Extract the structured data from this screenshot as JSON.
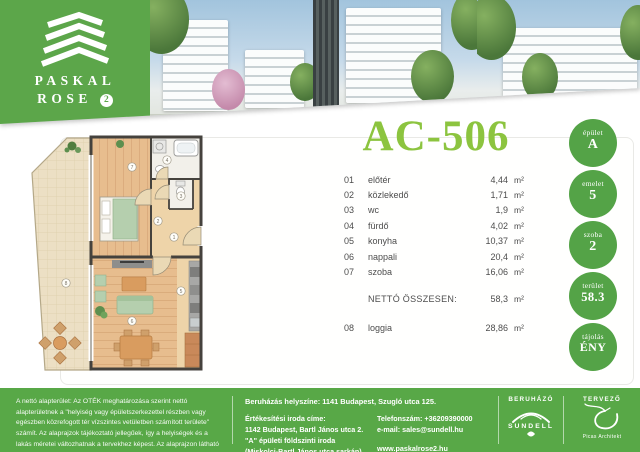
{
  "colors": {
    "brand_green": "#5ca64a",
    "badge_green": "#54a347",
    "footer_green": "#58a847",
    "title_green": "#8cc43f"
  },
  "logo": {
    "line1": "PASKAL",
    "line2": "ROSE",
    "badge": "2"
  },
  "unit": {
    "code": "AC-506"
  },
  "rooms": [
    {
      "num": "01",
      "name": "előtér",
      "area": "4,44",
      "unit": "m²"
    },
    {
      "num": "02",
      "name": "közlekedő",
      "area": "1,71",
      "unit": "m²"
    },
    {
      "num": "03",
      "name": "wc",
      "area": "1,9",
      "unit": "m²"
    },
    {
      "num": "04",
      "name": "fürdő",
      "area": "4,02",
      "unit": "m²"
    },
    {
      "num": "05",
      "name": "konyha",
      "area": "10,37",
      "unit": "m²"
    },
    {
      "num": "06",
      "name": "nappali",
      "area": "20,4",
      "unit": "m²"
    },
    {
      "num": "07",
      "name": "szoba",
      "area": "16,06",
      "unit": "m²"
    }
  ],
  "total": {
    "label": "NETTÓ ÖSSZESEN:",
    "value": "58,3",
    "unit": "m²"
  },
  "loggia_row": {
    "num": "08",
    "name": "loggia",
    "area": "28,86",
    "unit": "m²"
  },
  "badges": [
    {
      "label": "épület",
      "value": "A"
    },
    {
      "label": "emelet",
      "value": "5"
    },
    {
      "label": "szoba",
      "value": "2"
    },
    {
      "label": "terület",
      "value": "58.3"
    },
    {
      "label": "tájolás",
      "value": "ÉNY"
    }
  ],
  "plan": {
    "numbers": [
      "1",
      "2",
      "3",
      "4",
      "5",
      "6",
      "7",
      "8"
    ]
  },
  "footer": {
    "disclaimer": "A nettó alapterület: Az OTÉK meghatározása szerint nettó alapterületnek a \"helyiség vagy épületszerkezettel részben vagy egészben közrefogott tér vízszintes vetületben számított területe\" számít. Az alaprajzok tájékoztató jellegűek, így a helyiségek és a lakás méretei változhatnak a tervekhez képest. Az alaprajzon látható bútorok illusztrációk, pontos felszereltség a műszaki leírás szerint.",
    "location": "Beruházás helyszíne: 1141 Budapest, Szugló utca 125.",
    "office_title": "Értékesítési iroda címe:",
    "office_lines": [
      "1142 Budapest, Bartl János utca 2.",
      "\"A\" épületi földszinti iroda",
      "(Miskolci-Bartl János utca sarkán)"
    ],
    "phone": "Telefonszám: +36209390000",
    "email": "e-mail: sales@sundell.hu",
    "website": "www.paskalrose2.hu",
    "developer_label": "BERUHÁZÓ",
    "developer_name": "SUNDELL",
    "designer_label": "TERVEZŐ",
    "designer_name": "Picas Architekt"
  }
}
